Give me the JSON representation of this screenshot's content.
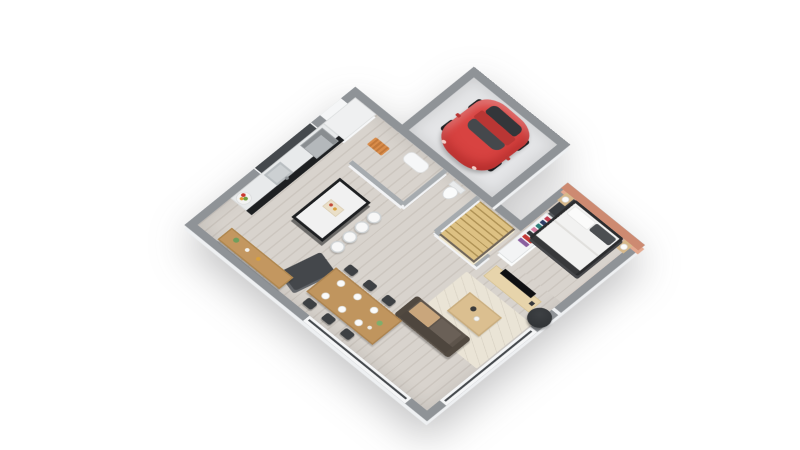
{
  "scene": {
    "title": "3D isometric floor plan of a single-storey house with attached garage",
    "background": "#ffffff"
  },
  "colors": {
    "wall": "#8f9397",
    "wall-int": "#a6abaf",
    "floor-a": "#d8d3cd",
    "floor-b": "#ccc6bf",
    "garage-floor": "#e4e5e7",
    "accent": "#cd8a71",
    "car-red": "#d84341",
    "car-red-dark": "#b93634",
    "glass": "#45494d",
    "white-frame": "#f5f6f7",
    "counter": "#e8eaeb",
    "cabinet-black": "#1d1f21",
    "stairs-wood": "#ddc183",
    "table-wood": "#c0955e",
    "sideboard-wood": "#c39760",
    "console-wood": "#e7d4ab",
    "coffee-wood": "#dbbf90",
    "sofa": "#5d544b",
    "sofa-back": "#4e463e",
    "cushion": "#c9a67c",
    "rug": "#eae4d6",
    "chair": "#3d4043",
    "pouf": "#2d3033",
    "bed-frame": "#2b2c2e",
    "bedding": "#f2f2f1",
    "nightstand": "#d7b98b",
    "dark-unit": "#3a3d41"
  },
  "rooms": [
    {
      "id": "garage",
      "name": "Garage"
    },
    {
      "id": "bedroom",
      "name": "Bedroom"
    },
    {
      "id": "kitchen",
      "name": "Kitchen"
    },
    {
      "id": "living-room",
      "name": "Living room"
    },
    {
      "id": "dining-area",
      "name": "Dining area"
    },
    {
      "id": "entry-hall",
      "name": "Entry hall"
    },
    {
      "id": "wc",
      "name": "WC"
    },
    {
      "id": "stairs",
      "name": "Winder staircase"
    }
  ],
  "furniture": {
    "car": {
      "label": "Red hatchback car"
    },
    "bed": {
      "label": "Double bed with white bedding"
    },
    "nightstands": {
      "label": "Nightstands with lamps"
    },
    "wardrobe": {
      "label": "Open wardrobe with clothes"
    },
    "dark_unit": {
      "label": "Tall dark cabinet"
    },
    "tv": {
      "label": "TV on media console"
    },
    "pouf": {
      "label": "Round dark pouf"
    },
    "sofa": {
      "label": "Brown fabric sofa"
    },
    "coffee_table": {
      "label": "Wooden coffee table"
    },
    "rug": {
      "label": "Beige area rug"
    },
    "dining_table": {
      "label": "Wooden dining table with place settings"
    },
    "dining_chairs": {
      "label": "Six dark dining chairs"
    },
    "sideboard": {
      "label": "Wooden sideboard with decor"
    },
    "island": {
      "label": "Kitchen island with bar stools"
    },
    "stools": {
      "label": "Four white bar stools"
    },
    "counter": {
      "label": "Black kitchen counter run with sink and hood"
    },
    "fridge": {
      "label": "Tall white kitchen unit"
    },
    "stove": {
      "label": "Freestanding dark stove panel"
    },
    "fruit_bowl": {
      "label": "Fruit bowl"
    },
    "toilet": {
      "label": "Toilet"
    },
    "entry_door": {
      "label": "Entry door"
    },
    "doormat": {
      "label": "Orange doormat"
    },
    "stairs": {
      "label": "Light wood winder stairs"
    },
    "windows": {
      "label": "Large picture windows"
    }
  }
}
